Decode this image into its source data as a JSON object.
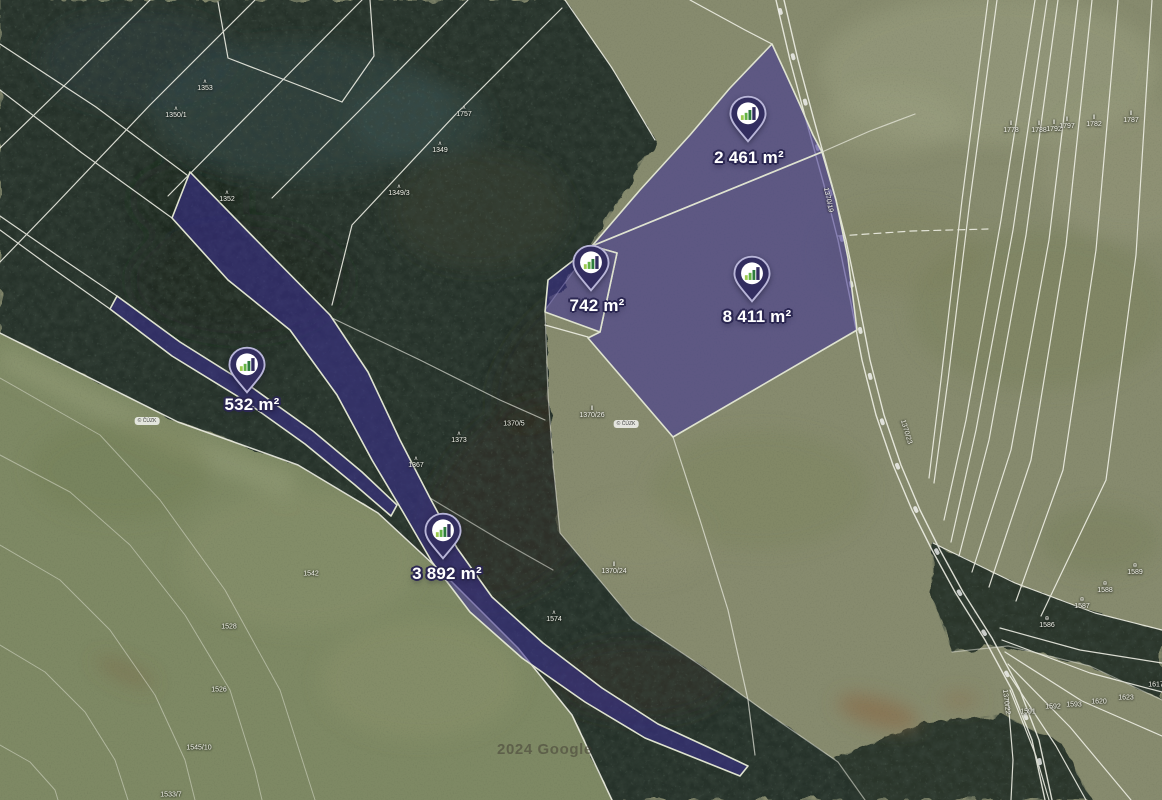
{
  "map": {
    "watermark": "2024 Google",
    "attribution_badge": "© ČÚZK",
    "colors": {
      "parcel_fill": "#3c3096",
      "parcel_outline": "#dfe3d0",
      "pin_body": "#322d5f",
      "pin_ring": "#b8b5d8",
      "pin_circle": "#ffffff",
      "bar_green_light": "#9ccb4f",
      "bar_green": "#63b244",
      "bar_green_dark": "#2e7d3c",
      "label_text": "#ffffff",
      "label_outline": "#2b2752"
    },
    "parcels": [
      {
        "name": "parcel-2461",
        "area_label": "2 461 m²",
        "pin_tip": {
          "x": 748,
          "y": 143
        },
        "label_pos": {
          "x": 749,
          "y": 158
        }
      },
      {
        "name": "parcel-742",
        "area_label": "742 m²",
        "pin_tip": {
          "x": 591,
          "y": 292
        },
        "label_pos": {
          "x": 597,
          "y": 306
        }
      },
      {
        "name": "parcel-8411",
        "area_label": "8 411 m²",
        "pin_tip": {
          "x": 752,
          "y": 303
        },
        "label_pos": {
          "x": 757,
          "y": 317
        }
      },
      {
        "name": "parcel-532",
        "area_label": "532 m²",
        "pin_tip": {
          "x": 247,
          "y": 394
        },
        "label_pos": {
          "x": 252,
          "y": 405
        }
      },
      {
        "name": "parcel-3892",
        "area_label": "3 892 m²",
        "pin_tip": {
          "x": 443,
          "y": 560
        },
        "label_pos": {
          "x": 447,
          "y": 574
        }
      }
    ],
    "cadastral_labels": [
      {
        "text": "1353",
        "x": 205,
        "y": 86,
        "symbol": "tree"
      },
      {
        "text": "1350/1",
        "x": 176,
        "y": 113,
        "symbol": "tree"
      },
      {
        "text": "1349",
        "x": 440,
        "y": 148,
        "symbol": "tree"
      },
      {
        "text": "1757",
        "x": 464,
        "y": 112,
        "symbol": "tree"
      },
      {
        "text": "1349/3",
        "x": 399,
        "y": 191,
        "symbol": "tree"
      },
      {
        "text": "1352",
        "x": 227,
        "y": 197,
        "symbol": "tree"
      },
      {
        "text": "1373",
        "x": 459,
        "y": 438,
        "symbol": "tree"
      },
      {
        "text": "1367",
        "x": 416,
        "y": 463,
        "symbol": "tree"
      },
      {
        "text": "1574",
        "x": 554,
        "y": 617,
        "symbol": "tree"
      },
      {
        "text": "1370/5",
        "x": 514,
        "y": 424
      },
      {
        "text": "1370/26",
        "x": 592,
        "y": 413,
        "symbol": "meadow"
      },
      {
        "text": "1370/24",
        "x": 614,
        "y": 569,
        "symbol": "meadow"
      },
      {
        "text": "1778",
        "x": 1011,
        "y": 128,
        "symbol": "meadow"
      },
      {
        "text": "1788",
        "x": 1039,
        "y": 128,
        "symbol": "meadow"
      },
      {
        "text": "1792",
        "x": 1054,
        "y": 127,
        "symbol": "meadow"
      },
      {
        "text": "1797",
        "x": 1067,
        "y": 124,
        "symbol": "meadow"
      },
      {
        "text": "1782",
        "x": 1094,
        "y": 122,
        "symbol": "meadow"
      },
      {
        "text": "1787",
        "x": 1131,
        "y": 118,
        "symbol": "meadow"
      },
      {
        "text": "1370/19",
        "x": 828,
        "y": 200,
        "rotate": 78
      },
      {
        "text": "1370/23",
        "x": 906,
        "y": 432,
        "rotate": 73
      },
      {
        "text": "1370/22",
        "x": 1006,
        "y": 702,
        "rotate": 83
      },
      {
        "text": "1586",
        "x": 1047,
        "y": 623,
        "symbol": "circle"
      },
      {
        "text": "1587",
        "x": 1082,
        "y": 604,
        "symbol": "circle"
      },
      {
        "text": "1588",
        "x": 1105,
        "y": 588,
        "symbol": "circle"
      },
      {
        "text": "1589",
        "x": 1135,
        "y": 570,
        "symbol": "circle"
      },
      {
        "text": "1591",
        "x": 1028,
        "y": 712
      },
      {
        "text": "1592",
        "x": 1053,
        "y": 707
      },
      {
        "text": "1593",
        "x": 1074,
        "y": 705
      },
      {
        "text": "1620",
        "x": 1099,
        "y": 702
      },
      {
        "text": "1623",
        "x": 1126,
        "y": 698
      },
      {
        "text": "1617",
        "x": 1156,
        "y": 685
      },
      {
        "text": "1542",
        "x": 311,
        "y": 574
      },
      {
        "text": "1528",
        "x": 229,
        "y": 627
      },
      {
        "text": "1526",
        "x": 219,
        "y": 690
      },
      {
        "text": "1545/10",
        "x": 199,
        "y": 748
      },
      {
        "text": "1533/7",
        "x": 171,
        "y": 795
      }
    ],
    "badges": [
      {
        "x": 147,
        "y": 421
      },
      {
        "x": 626,
        "y": 424
      }
    ]
  }
}
